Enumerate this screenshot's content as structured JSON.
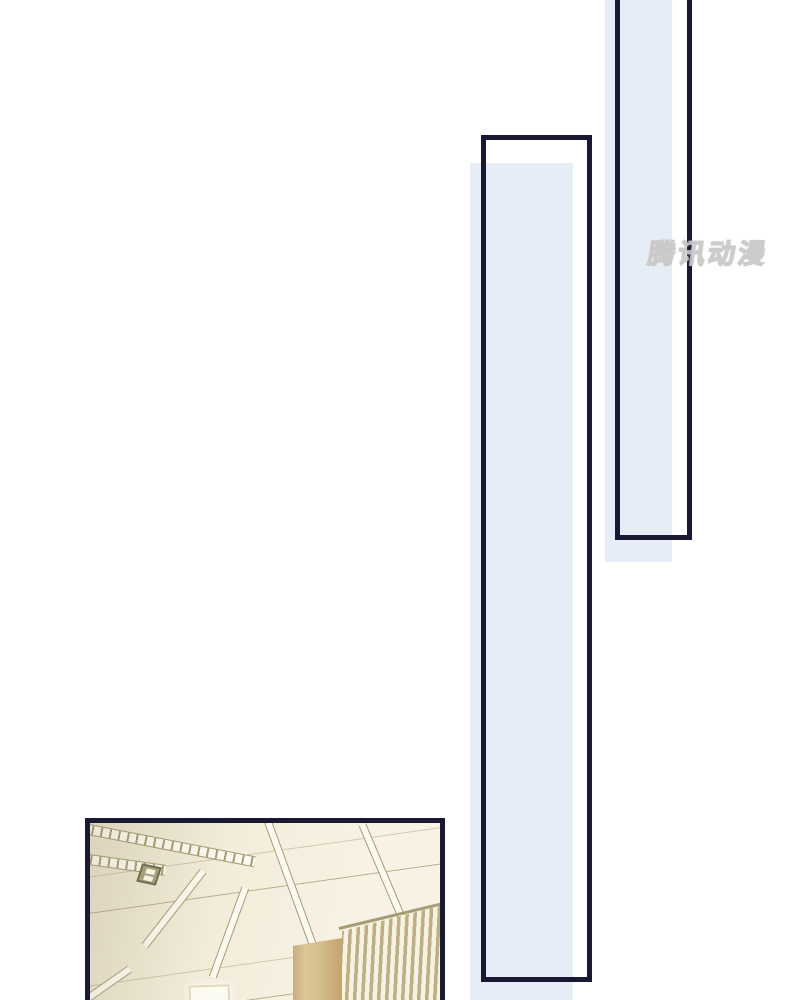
{
  "watermark": {
    "text": "腾讯动漫"
  },
  "colors": {
    "page_bg": "#ffffff",
    "panel_border": "#191933",
    "panel_fill": "#e7edf6",
    "ceiling_shade": "#ebe4cd",
    "ceiling_base": "#f2ecda",
    "ceiling_bright": "#f7f2e3",
    "seam": "#a79c74",
    "strip_white": "#fcfaf0",
    "wood_light": "#dbc69a",
    "wood_dark": "#c2a572",
    "slat_wood": "#bfae81",
    "slat_gap": "#f6f2e3",
    "fixture_border": "#6e6c50",
    "fixture_fill": "#a8a27d",
    "light_fill": "#fcfbf1",
    "light_border": "#e0dabf",
    "watermark_fill": "#ffffff",
    "watermark_stroke": "#c8c8c8"
  }
}
